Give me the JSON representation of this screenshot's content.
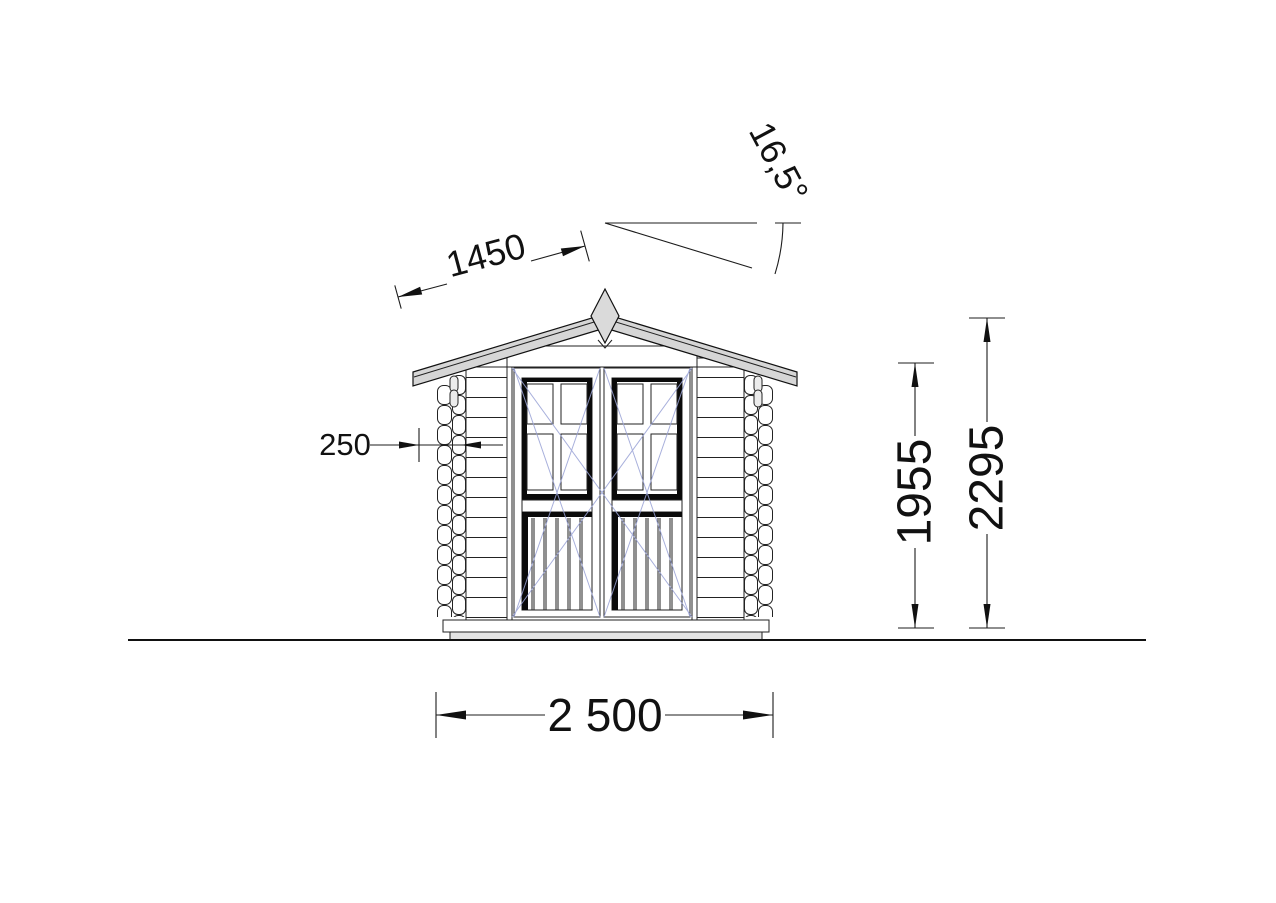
{
  "dimensions": {
    "roof_slope": "1450",
    "roof_angle": "16,5°",
    "corner_log_width": "250",
    "wall_height": "1955",
    "ridge_height": "2295",
    "overall_width": "2 500"
  },
  "colors": {
    "roof_fill": "#d6d6d6",
    "finial_fill": "#dadada",
    "base_fill": "#e4e4e4",
    "peg_fill": "#ececec",
    "door_swing": "#9aa3d6"
  }
}
